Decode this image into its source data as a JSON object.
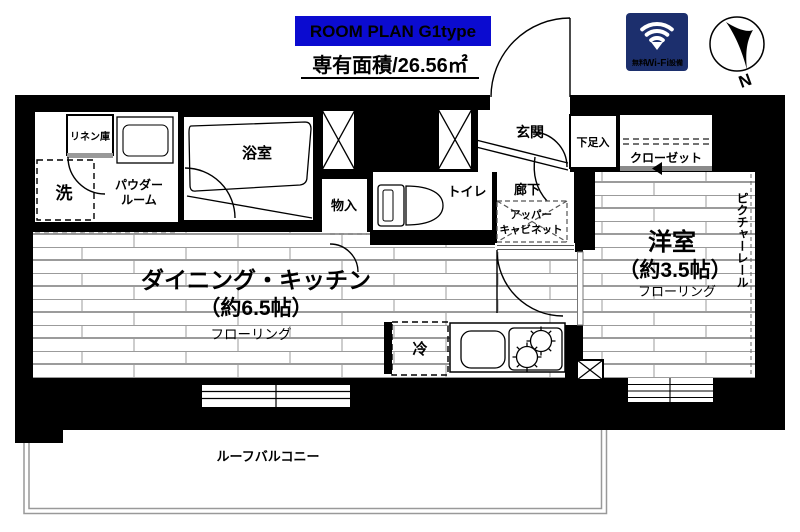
{
  "header": {
    "plan_label": "ROOM PLAN  G1type",
    "area_label": "専有面積/26.56㎡"
  },
  "wifi_badge": {
    "prefix": "無料",
    "brand": "Wi-Fi",
    "suffix": "設備"
  },
  "compass": {
    "north_label": "N"
  },
  "rooms": {
    "dining_kitchen": {
      "name": "ダイニング・キッチン",
      "size": "（約6.5帖）",
      "flooring": "フローリング"
    },
    "western_room": {
      "name": "洋室",
      "size": "（約3.5帖）",
      "flooring": "フローリング"
    },
    "picture_rail": "ピクチャーレール",
    "bathroom": "浴室",
    "powder_room_line1": "パウダー",
    "powder_room_line2": "ルーム",
    "linen_closet": "リネン庫",
    "washer": "洗",
    "storage": "物入",
    "toilet": "トイレ",
    "entrance": "玄関",
    "corridor": "廊下",
    "upper_cabinet_line1": "アッパー",
    "upper_cabinet_line2": "キャビネット",
    "shoe_box": "下足入",
    "closet": "クローゼット",
    "fridge": "冷",
    "roof_balcony": "ルーフバルコニー"
  },
  "colors": {
    "plan_blue": "#0b0bd0",
    "wifi_navy": "#1c2f6d",
    "wall_black": "#000000"
  }
}
